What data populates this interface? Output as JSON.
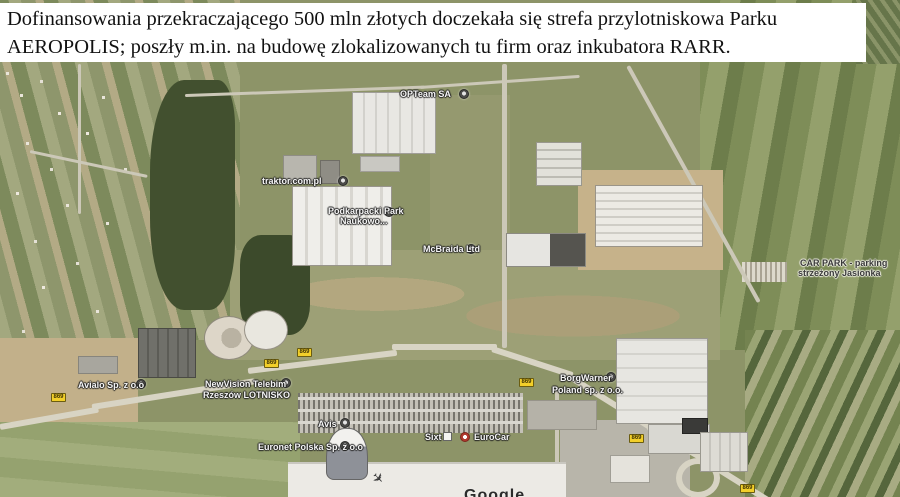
{
  "caption": {
    "line1": "Dofinansowania przekraczającego 500 mln złotych doczekała się strefa przylotniskowa Parku",
    "line2": "AEROPOLIS; poszły m.in. na budowę zlokalizowanych tu firm oraz inkubatora RARR."
  },
  "map": {
    "type": "satellite-aerial-view",
    "labels": {
      "opteam": "OPTeam SA",
      "traktor": "traktor.com.pl",
      "park_naukowy": {
        "line1": "Podkarpacki Park",
        "line2": "Naukowo..."
      },
      "mcbraida": "McBraida Ltd",
      "car_park": {
        "line1": "CAR PARK - parking",
        "line2": "strzeżony Jasionka"
      },
      "avialo": "Avialo Sp. z o.o",
      "newvision": {
        "line1": "NewVision Telebim",
        "line2": "Rzeszów LOTNISKO"
      },
      "borgwarner": {
        "line1": "BorgWarner",
        "line2": "Poland sp. z o.o."
      },
      "avis": "Avis",
      "euronet": "Euronet Polska Sp. z o.o",
      "sixt": "Sixt",
      "eurocar": "EuroCar"
    },
    "road_badge": {
      "number": "869"
    },
    "watermark": "Google",
    "icons": {
      "airplane": "✈",
      "poi_marker": "dot-circle",
      "sixt_logo": "white-square",
      "eurocar_logo": "red-circle"
    },
    "colors": {
      "road_badge_yellow": "#f2cf2a",
      "label_text": "#f5f5f5",
      "label_halo": "#222222",
      "dark_label_text": "#3a3a3a",
      "caption_background": "#ffffff",
      "caption_text": "#111111"
    }
  }
}
